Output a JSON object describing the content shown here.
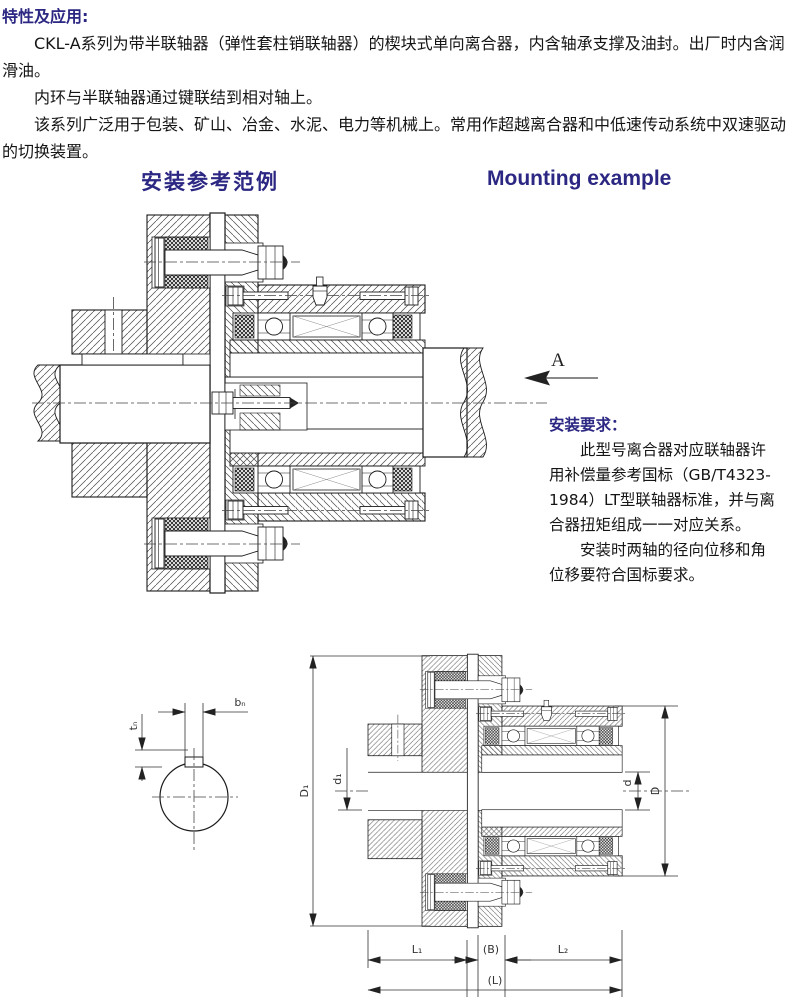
{
  "page": {
    "background": "#ffffff",
    "accent_color": "#2b2782",
    "text_color": "#151515"
  },
  "intro": {
    "heading": "特性及应用:",
    "paragraphs": [
      "CKL-A系列为带半联轴器（弹性套柱销联轴器）的楔块式单向离合器，内含轴承支撑及油封。出厂时内含润滑油。",
      "内环与半联轴器通过键联结到相对轴上。",
      "该系列广泛用于包装、矿山、冶金、水泥、电力等机械上。常用作超越离合器和中低速传动系统中双速驱动的切换装置。"
    ]
  },
  "section_titles": {
    "zh": "安装参考范例",
    "en": "Mounting example"
  },
  "view_label": "A",
  "requirements": {
    "heading": "安装要求：",
    "paragraphs": [
      "此型号离合器对应联轴器许用补偿量参考国标（GB/T4323-1984）LT型联轴器标准，并与离合器扭矩组成一一对应关系。",
      "安装时两轴的径向位移和角位移要符合国标要求。"
    ]
  },
  "dimensions": {
    "D1": "D₁",
    "d1": "d₁",
    "d": "d",
    "D": "D",
    "L1": "L₁",
    "B": "(B)",
    "L2": "L₂",
    "L": "(L)",
    "bn": "bₙ",
    "tn": "tₙ"
  }
}
